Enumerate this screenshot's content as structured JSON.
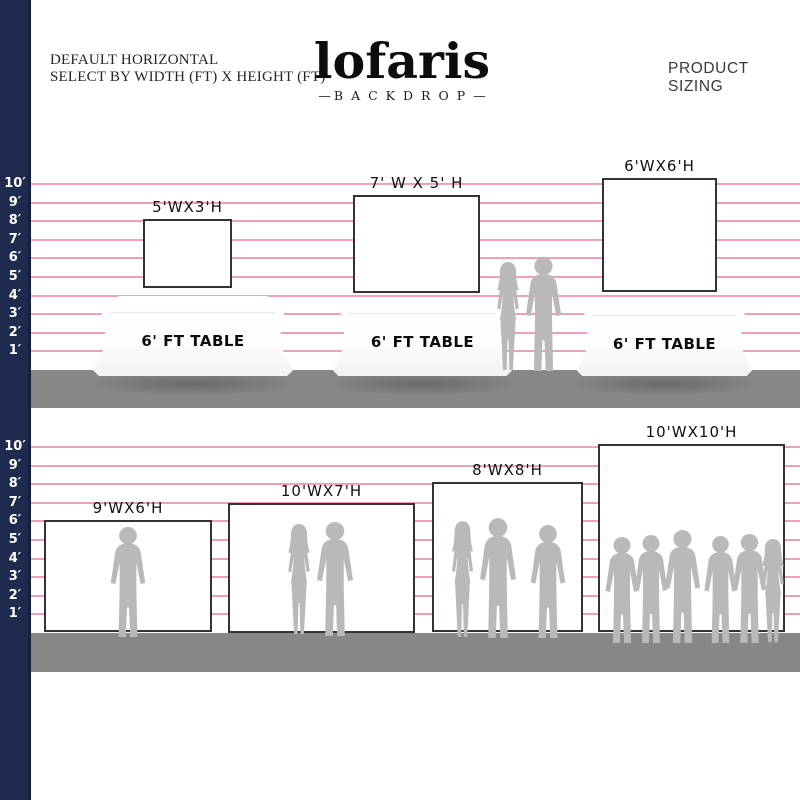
{
  "header": {
    "left_line1": "DEFAULT HORIZONTAL",
    "left_line2": "SELECT BY WIDTH (FT) X HEIGHT (FT)",
    "logo": {
      "name": "lofaris",
      "sub": "BACKDROP",
      "flank": "—"
    },
    "right_title": "PRODUCT SIZING"
  },
  "ruler_labels": [
    "10′",
    "9′",
    "8′",
    "7′",
    "6′",
    "5′",
    "4′",
    "3′",
    "2′",
    "1′"
  ],
  "top_scene": {
    "backdrops": [
      {
        "label": "5'WX3'H",
        "width_ft": 5,
        "height_ft": 3
      },
      {
        "label": "7' W X 5' H",
        "width_ft": 7,
        "height_ft": 5
      },
      {
        "label": "6'WX6'H",
        "width_ft": 6,
        "height_ft": 6
      }
    ],
    "tables": [
      {
        "label": "6' FT TABLE"
      },
      {
        "label": "6' FT TABLE"
      },
      {
        "label": "6' FT TABLE"
      }
    ],
    "people_count": 2
  },
  "bottom_scene": {
    "backdrops": [
      {
        "label": "9'WX6'H",
        "width_ft": 9,
        "height_ft": 6,
        "people_count": 1
      },
      {
        "label": "10'WX7'H",
        "width_ft": 10,
        "height_ft": 7,
        "people_count": 2
      },
      {
        "label": "8'WX8'H",
        "width_ft": 8,
        "height_ft": 8,
        "people_count": 3
      },
      {
        "label": "10'WX10'H",
        "width_ft": 10,
        "height_ft": 10,
        "people_count": 6
      }
    ]
  },
  "colors": {
    "navy": "#1e2a4e",
    "navy_edge": "#17213f",
    "gridline": "#efa0b4",
    "floor": "#878787",
    "silhouette": "#b9b9bb",
    "backdrop_border": "#333333"
  }
}
